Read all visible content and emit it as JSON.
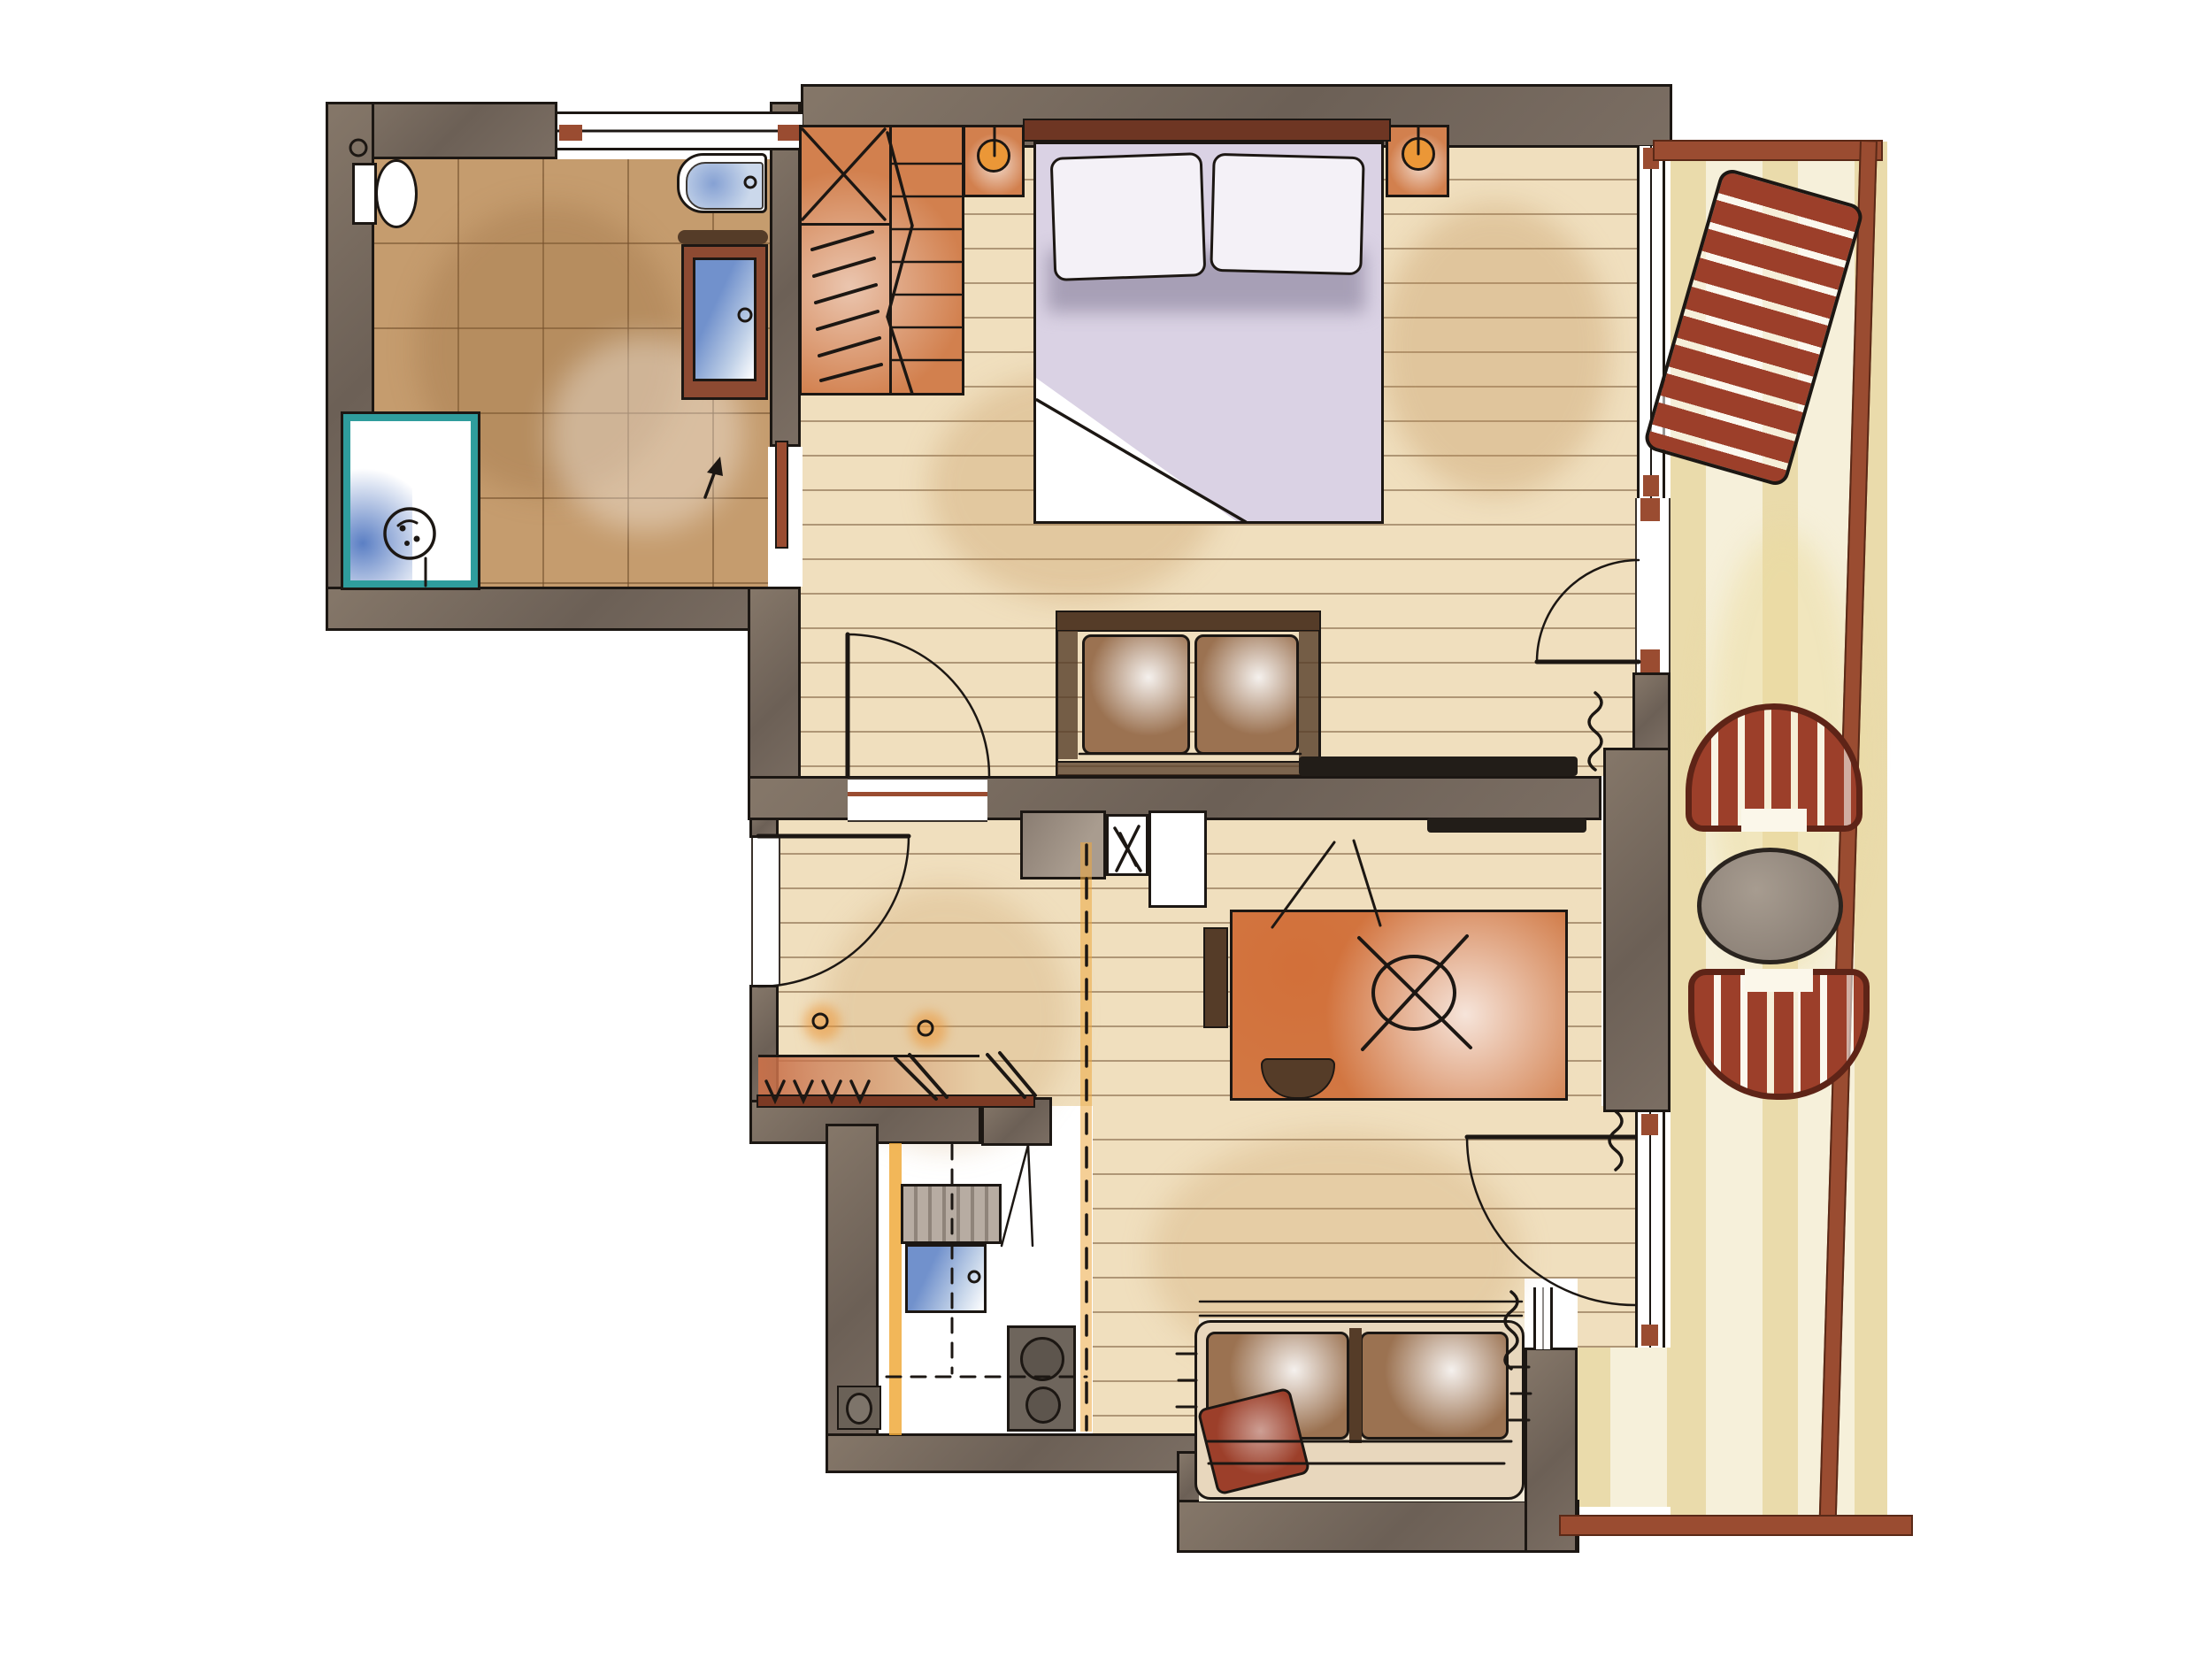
{
  "document": {
    "kind": "hand-drawn watercolor apartment floor plan",
    "orientation": "top-down",
    "visible_text": "none"
  },
  "colors": {
    "ink": "#1c1713",
    "wall": "#7b6e63",
    "wallHi": "#857769",
    "wallLo": "#6c6056",
    "tile_floor": "#c59c6e",
    "wood_floor": "#f0dfbe",
    "balcony_floor": "#f6f0da",
    "accent_red": "#9c3f2a",
    "accent_red_dark": "#6e2718",
    "window_sill": "#9a4c31",
    "furniture_orange": "#d2804e",
    "bedding_lavender": "#dad2e4",
    "bedding_shadow": "#a79fb6",
    "water_blue": "#7191cc",
    "water_blue_light": "#c2d2e8",
    "shower_teal": "#2f9d9d",
    "sofa_brown": "#9b7251",
    "sofa_brown_dark": "#553c28",
    "lamp_orange": "#eb9737",
    "floor_marking_dash": "#eda83f",
    "balcony_table_gray": "#8b8076"
  },
  "rooms": [
    {
      "name": "bathroom",
      "floor": "brown ceramic tile",
      "fixtures": [
        "toilet",
        "wall-fixture-ring",
        "bathtub-with-faucet",
        "vanity-sink-wood-cabinet",
        "shower-teal-tray-with-drain",
        "sliding-door-to-bedroom"
      ]
    },
    {
      "name": "bedroom",
      "floor": "light wood planks",
      "fixtures": [
        "wardrobe-with-shelves-and-hanging-rod",
        "folding-wardrobe-door",
        "double-bed-lavender-bedding",
        "two-pillows",
        "headboard",
        "nightstand-left-with-lamp",
        "nightstand-right-with-lamp",
        "two-seat-sofa",
        "wall-tv-bedroom-side",
        "door-to-hall",
        "balcony-door-with-swing",
        "window-band",
        "curtain"
      ]
    },
    {
      "name": "hall",
      "floor": "light wood planks",
      "fixtures": [
        "entry-door-with-swing",
        "coat-shelf",
        "four-coat-hooks",
        "two-hanging-coats",
        "coat-rail",
        "two-floor-sockets"
      ]
    },
    {
      "name": "living-work-area",
      "floor": "light wood planks",
      "fixtures": [
        "kitchenette-counter-with-sink",
        "wall-tv-living-side",
        "desk-orange",
        "desk-chair-cross-symbol",
        "seat-pad",
        "stool",
        "dashed-floor-marking",
        "balcony-door-with-swing",
        "curtains"
      ]
    },
    {
      "name": "kitchen",
      "floor": "white",
      "fixtures": [
        "tall-unit-with-slats",
        "open-cabinet-flap",
        "sink-blue",
        "two-burner-stove",
        "waste-recess",
        "counter-dashed-overhang",
        "orange-counter-edge"
      ]
    },
    {
      "name": "seating-nook",
      "floor": "cream",
      "fixtures": [
        "built-in-bench-two-cushions",
        "dark-divider-armrest",
        "red-cushion",
        "window-band-behind-bench",
        "curtain"
      ]
    },
    {
      "name": "balcony",
      "floor": "cream planks",
      "fixtures": [
        "sun-lounger-red-slats",
        "armchair-red-striped-north",
        "round-table-gray",
        "armchair-red-striped-south",
        "railing-top",
        "railing-right",
        "railing-bottom"
      ]
    }
  ],
  "windows": [
    {
      "name": "bathroom-top-window",
      "wall": "north"
    },
    {
      "name": "bedroom-east-window",
      "wall": "east"
    },
    {
      "name": "living-east-window-door",
      "wall": "east"
    },
    {
      "name": "nook-east-window",
      "wall": "east"
    }
  ],
  "doors": [
    {
      "name": "entry-door",
      "swing": "into-hall"
    },
    {
      "name": "bedroom-door",
      "swing": "into-bedroom"
    },
    {
      "name": "bathroom-sliding-door",
      "type": "sliding",
      "marker": "arrow"
    },
    {
      "name": "bedroom-balcony-door",
      "swing": "into-bedroom"
    },
    {
      "name": "living-balcony-door",
      "swing": "into-living"
    }
  ]
}
